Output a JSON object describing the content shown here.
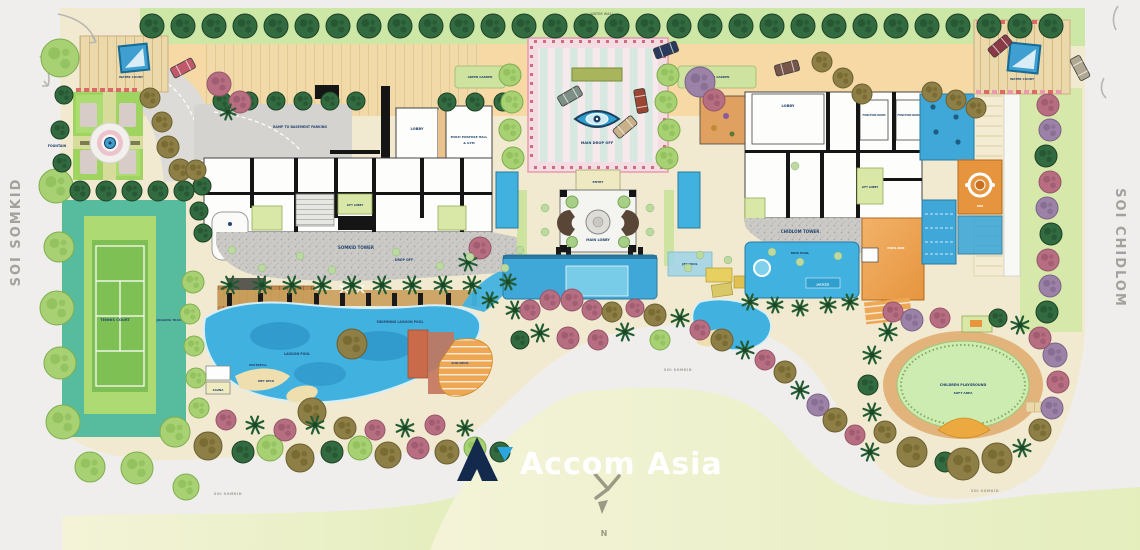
{
  "streets": {
    "left": "SOI SOMKID",
    "right": "SOI CHIDLOM"
  },
  "roads": {
    "label": "SOI SOMKID"
  },
  "compass": {
    "north": "N"
  },
  "watermark": {
    "brand": "Accom Asia"
  },
  "areas": {
    "water_wall": "WATER WALL",
    "ramp": "RAMP TO BASEMENT PARKING",
    "lobby": "LOBBY",
    "hall1": "MULTI PURPOSE HALL",
    "hall2": "& GYM",
    "lift_lobby": "LIFT LOBBY",
    "somkid_tower": "SOMKID TOWER",
    "drop_off": "DROP OFF",
    "main_drop_off": "MAIN DROP OFF",
    "entry": "ENTRY",
    "main_lobby": "MAIN LOBBY",
    "green_garden": "GREEN GARDEN",
    "lobby_r": "LOBBY",
    "function_room": "FUNCTION ROOM",
    "chidlom_tower": "CHIDLOM TOWER",
    "kids_pool": "KIDS POOL",
    "jacuzzi": "JACUZZI",
    "jet_pool": "JET POOL",
    "pool_bar": "POOL BAR",
    "spa": "SPA",
    "lagoon_pool": "LAGOON POOL",
    "swimming_pool": "SWIMMING LAGOON POOL",
    "waterfall": "WATERFALL",
    "wet_deck": "WET DECK",
    "sun_deck": "SUN DECK",
    "sauna": "SAUNA",
    "tennis": "TENNIS COURT",
    "jogging": "JOGGING TRACK",
    "fountain": "FOUNTAIN",
    "water_court": "WATER COURT",
    "playground1": "CHILDREN PLAYGROUND",
    "playground2": "SOFT AREA"
  },
  "colors": {
    "pool_blue": "#41b2e0",
    "landscape_green": "#cde7a6",
    "brand_navy": "#132a4d",
    "brand_blue": "#2aa7e0"
  }
}
